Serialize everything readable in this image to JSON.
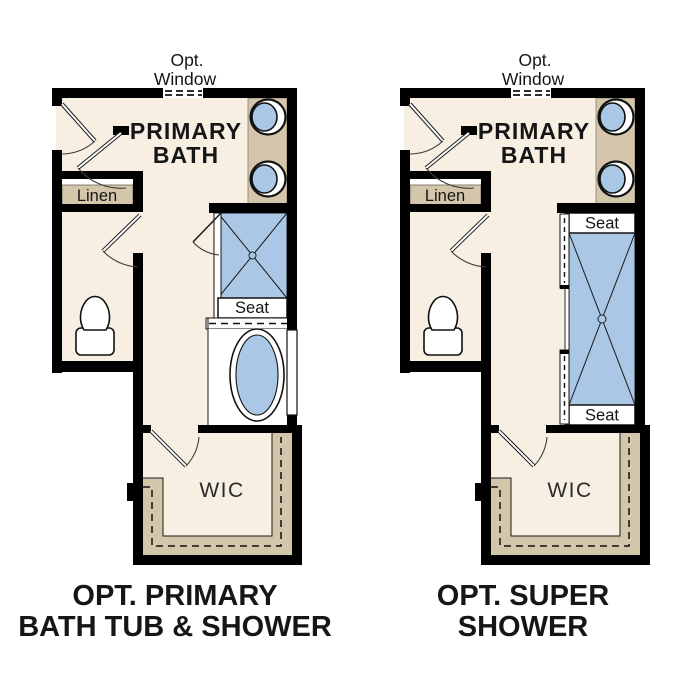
{
  "page": {
    "background": "#ffffff"
  },
  "colors": {
    "wall_black": "#000000",
    "floor_cream": "#f6efe2",
    "cabinet_tan": "#d4c6ab",
    "fixture_blue": "#aac8e6",
    "fixture_white": "#ffffff",
    "text_dark": "#161616"
  },
  "plans": {
    "left": {
      "name": "opt-primary-bath-tub-and-shower",
      "opt_window": {
        "line1": "Opt.",
        "line2": "Window"
      },
      "room": {
        "line1": "PRIMARY",
        "line2": "BATH"
      },
      "linen": "Linen",
      "seat": "Seat",
      "wic": "WIC",
      "title": {
        "line1": "OPT. PRIMARY",
        "line2": "BATH TUB & SHOWER"
      }
    },
    "right": {
      "name": "opt-super-shower",
      "opt_window": {
        "line1": "Opt.",
        "line2": "Window"
      },
      "room": {
        "line1": "PRIMARY",
        "line2": "BATH"
      },
      "linen": "Linen",
      "seat_top": "Seat",
      "seat_bottom": "Seat",
      "wic": "WIC",
      "title": {
        "line1": "OPT. SUPER",
        "line2": "SHOWER"
      }
    }
  }
}
